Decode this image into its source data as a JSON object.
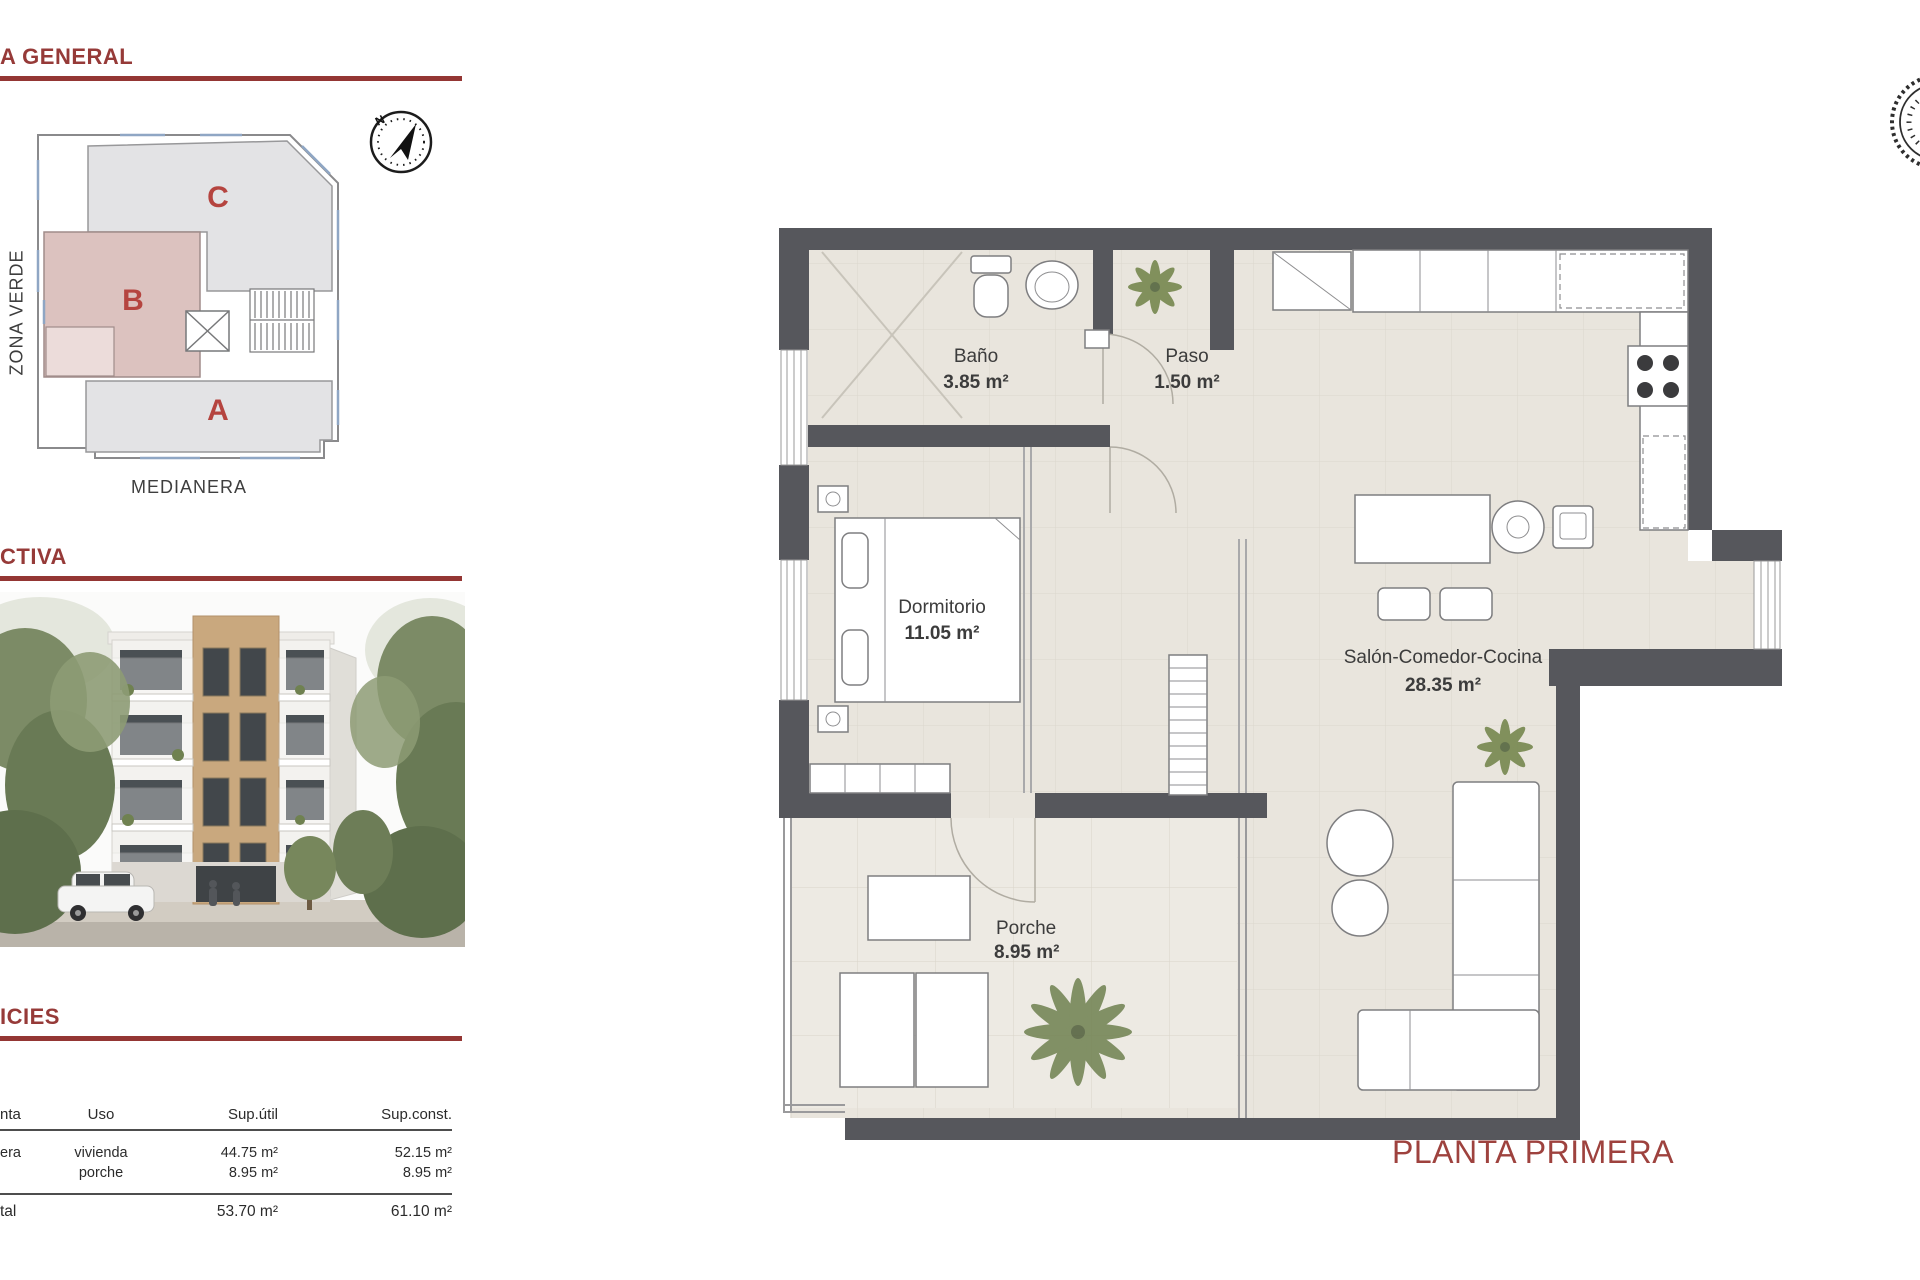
{
  "left_panel": {
    "site_plan": {
      "heading": "A GENERAL",
      "zona_verde_label": "ZONA VERDE",
      "medianera_label": "MEDIANERA",
      "unit_a_label": "A",
      "unit_b_label": "B",
      "unit_c_label": "C",
      "compass_n": "N",
      "highlight_color": "#DCC2BF"
    },
    "perspective": {
      "heading": "CTIVA"
    },
    "surfaces": {
      "heading": "ICIES",
      "table": {
        "col_planta": "nta",
        "col_uso": "Uso",
        "col_sup_util": "Sup.útil",
        "col_sup_const": "Sup.const.",
        "row1_planta": "era",
        "row1_uso": "vivienda",
        "row1_sup_util": "44.75 m²",
        "row1_sup_const": "52.15 m²",
        "row2_uso": "porche",
        "row2_sup_util": "8.95 m²",
        "row2_sup_const": "8.95 m²",
        "total_planta": "tal",
        "total_sup_util": "53.70 m²",
        "total_sup_const": "61.10 m²"
      }
    }
  },
  "floor_plan": {
    "title": "PLANTA PRIMERA",
    "rooms": {
      "bano": {
        "name": "Baño",
        "area": "3.85 m²"
      },
      "paso": {
        "name": "Paso",
        "area": "1.50 m²"
      },
      "dormitorio": {
        "name": "Dormitorio",
        "area": "11.05 m²"
      },
      "salon": {
        "name": "Salón-Comedor-Cocina",
        "area": "28.35 m²"
      },
      "porche": {
        "name": "Porche",
        "area": "8.95 m²"
      }
    }
  },
  "colors": {
    "accent_red": "#943634",
    "label_red": "#B5443F",
    "wall_dark": "#56575C",
    "floor_beige": "#E9E5DD"
  }
}
